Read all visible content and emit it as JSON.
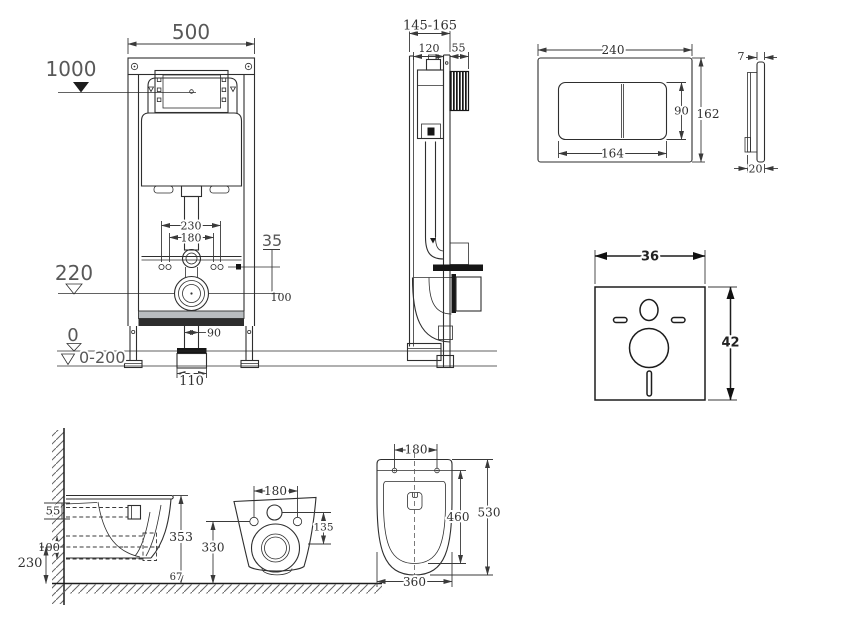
{
  "title": "Wall-hung WC installation frame technical drawing",
  "colors": {
    "line": "#2e2e2e",
    "dim_text": "#2f2f2f",
    "big_label": "#585858",
    "dark_fill": "#161616",
    "background": "#ffffff"
  },
  "views": {
    "frame_front": {
      "width": "500",
      "install_height": "1000",
      "bolt_span_outer": "230",
      "bolt_span_inner": "180",
      "bolt_offset": "35",
      "outlet_height": "220",
      "outlet_offset": "100",
      "pipe_width": "90",
      "drain_width": "110",
      "floor_level": "0",
      "adjust_range": "0-200"
    },
    "frame_side": {
      "depth_range": "145-165",
      "frame_depth": "120",
      "box_depth": "55"
    },
    "flush_plate": {
      "width": "240",
      "height": "162",
      "button_span": "164",
      "button_height": "90",
      "lip": "7",
      "depth": "20"
    },
    "sound_mat": {
      "width": "36",
      "height": "42"
    },
    "wc_side": {
      "rim_to_bolt": "55",
      "drain_spacing": "100",
      "drain_height": "230",
      "height": "353",
      "floor_note": "67"
    },
    "wc_back": {
      "bolt_span": "180",
      "inlet_to_bolt": "135",
      "bolt_height": "330"
    },
    "wc_top": {
      "bolt_span": "180",
      "seat_length": "460",
      "length": "530",
      "width": "360"
    }
  }
}
